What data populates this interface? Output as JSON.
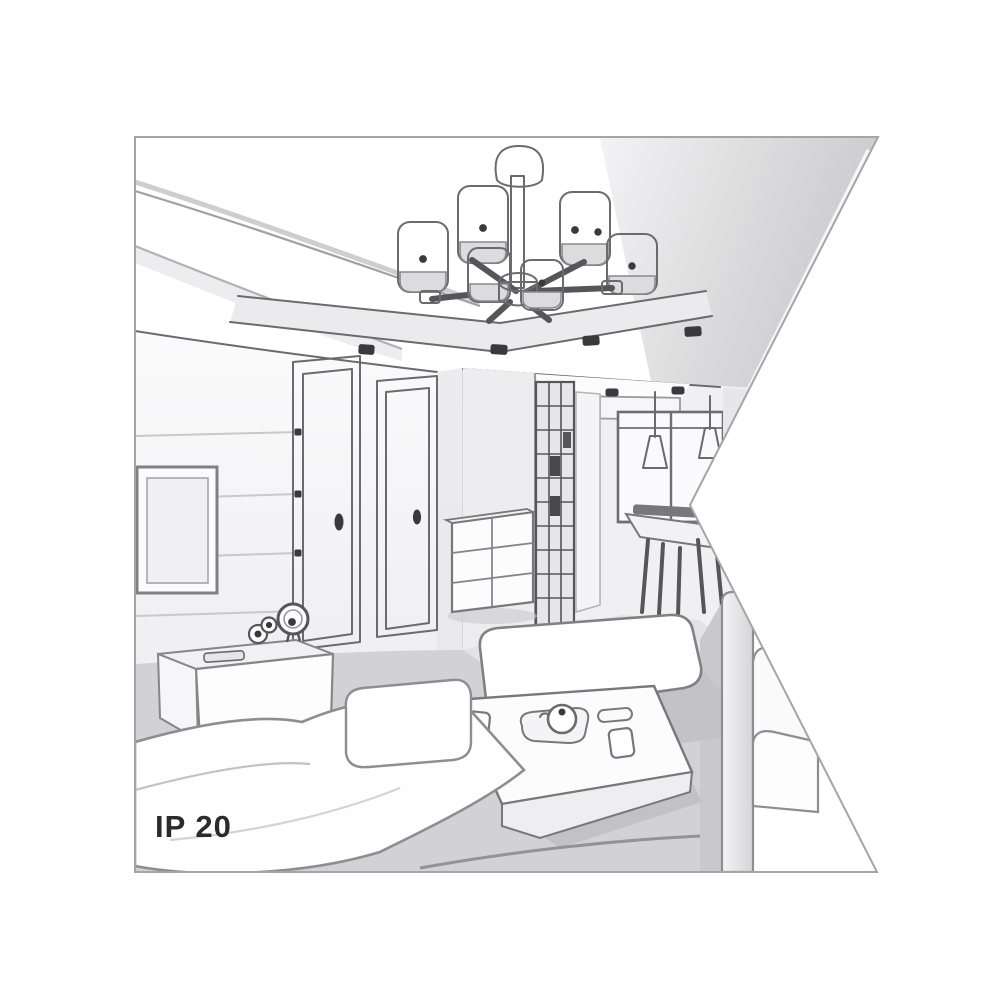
{
  "illustration": {
    "caption": "IP 20",
    "objects": [
      "ceiling-chandelier-6-shades",
      "recessed-ceiling-downlights",
      "tv-screen",
      "door",
      "door",
      "glass-cabinet",
      "drawer-chest",
      "kitchen-window",
      "pendant-cone-lamps",
      "dining-table-with-chairs",
      "tv-sideboard",
      "wall-clock",
      "sofa-left",
      "sofa-right",
      "bench-sofa",
      "coffee-table",
      "teapot-tray",
      "cups"
    ]
  },
  "colors": {
    "line": "#6a6a6f",
    "line-dark": "#3a3a3e",
    "wall": "#f6f6f8",
    "ceiling": "#cdcdd1",
    "floor": "#d2d2d6",
    "text": "#2b2b2e",
    "bg": "#ffffff",
    "frame": "#a5a5a9"
  }
}
